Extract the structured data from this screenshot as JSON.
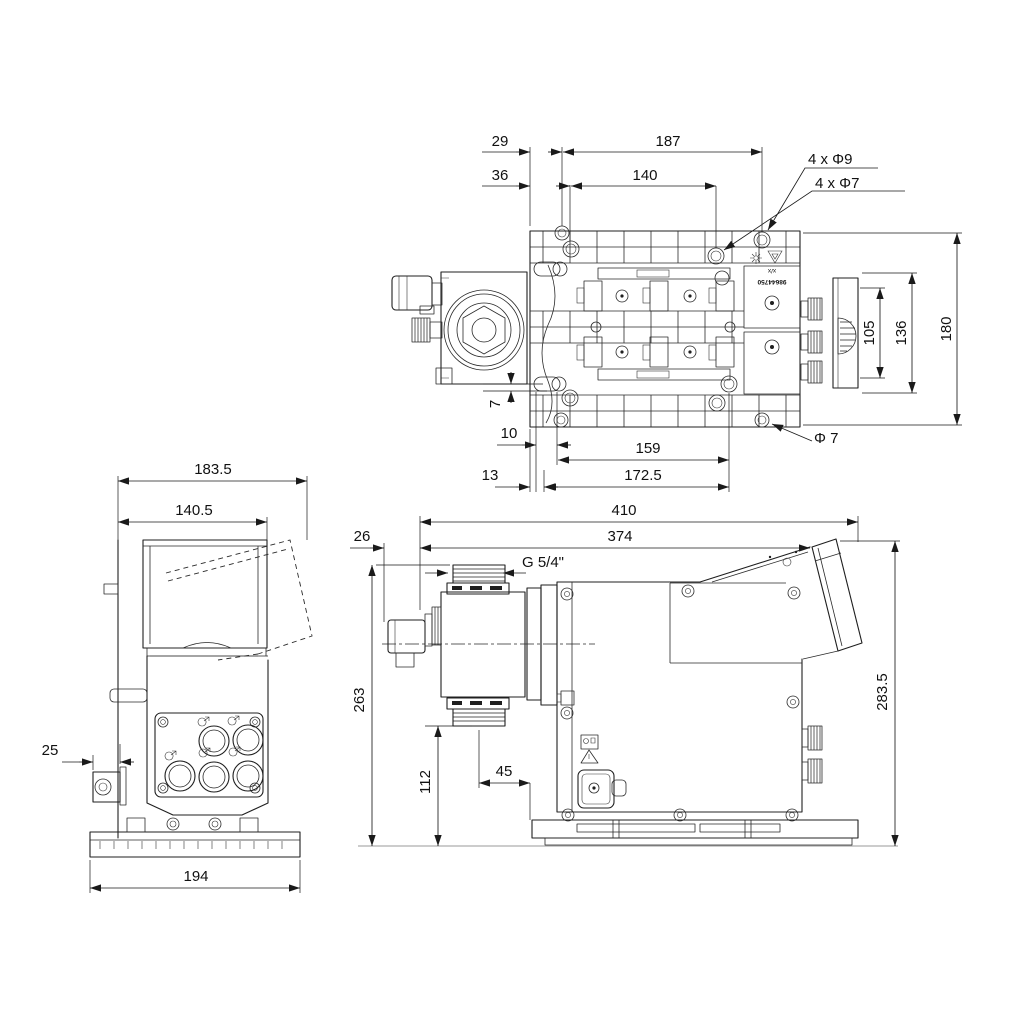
{
  "views": {
    "top": {
      "dims": {
        "d29": "29",
        "d187": "187",
        "d36": "36",
        "d140": "140",
        "holes9": "4 x Φ9",
        "holes7": "4 x Φ7",
        "d105": "105",
        "d136": "136",
        "d180": "180",
        "d7": "7",
        "d10": "10",
        "d159": "159",
        "phi7": "Φ 7",
        "d13": "13",
        "d172_5": "172.5"
      },
      "labels": {
        "orientation": "x/x",
        "part_number": "98644750"
      }
    },
    "front": {
      "dims": {
        "d183_5": "183.5",
        "d140_5": "140.5",
        "d25": "25",
        "d194": "194"
      }
    },
    "side": {
      "dims": {
        "d410": "410",
        "d26": "26",
        "d374": "374",
        "thread": "G 5/4\"",
        "d263": "263",
        "d112": "112",
        "d45": "45",
        "d283_5": "283.5"
      }
    }
  },
  "colors": {
    "line": "#1f1f1f",
    "background": "#ffffff"
  }
}
